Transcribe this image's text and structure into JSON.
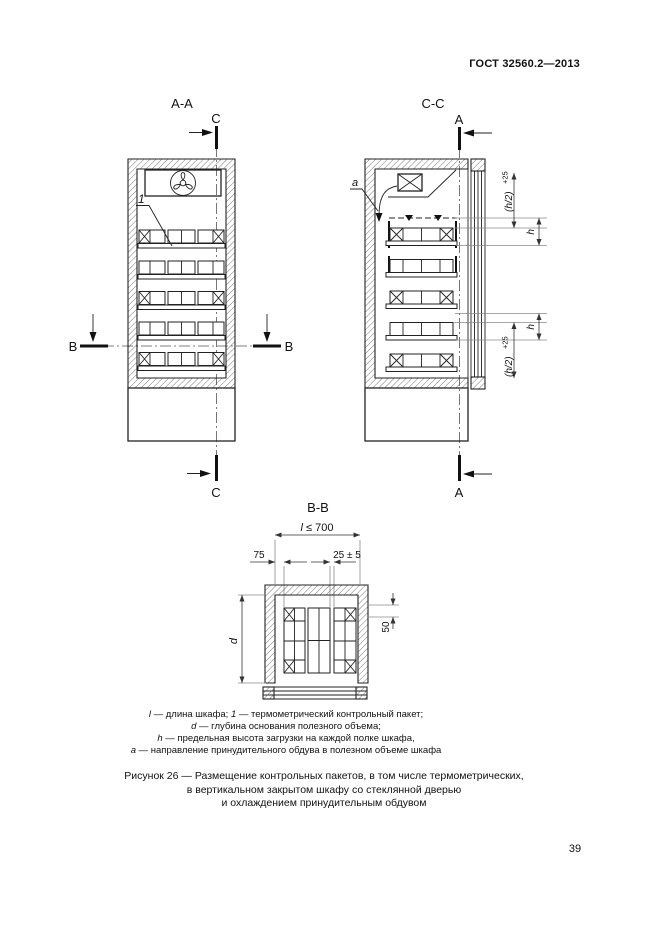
{
  "page": {
    "header": "ГОСТ 32560.2—2013",
    "page_number": "39"
  },
  "views": {
    "aa": {
      "title": "A-A"
    },
    "cc": {
      "title": "C-C"
    },
    "bb": {
      "title": "B-B"
    }
  },
  "marks": {
    "a": "A",
    "b": "B",
    "c": "C"
  },
  "labels": {
    "item": "1",
    "airflow": "a"
  },
  "dims": {
    "length_sym": "l",
    "length_val": "≤ 700",
    "offset_left": "75",
    "package_gap": "25 ± 5",
    "depth": "d",
    "back_offset": "50",
    "load_height": "h",
    "half_height": "(h/2)",
    "half_height_tol": "+25"
  },
  "legend": {
    "items": [
      {
        "symbol": "l",
        "desc": "— длина шкафа;"
      },
      {
        "symbol": "1",
        "desc": "— термометрический контрольный пакет;"
      },
      {
        "symbol": "d",
        "desc": "— глубина основания полезного объема;"
      },
      {
        "symbol": "h",
        "desc": "— предельная высота загрузки на каждой полке шкафа,"
      },
      {
        "symbol": "a",
        "desc": "— направление принудительного обдува в полезном объеме шкафа"
      }
    ]
  },
  "caption": {
    "lines": [
      "Рисунок 26 — Размещение контрольных пакетов, в том числе термометрических,",
      "в вертикальном закрытом шкафу со стеклянной дверью",
      "и охлаждением принудительным обдувом"
    ]
  }
}
